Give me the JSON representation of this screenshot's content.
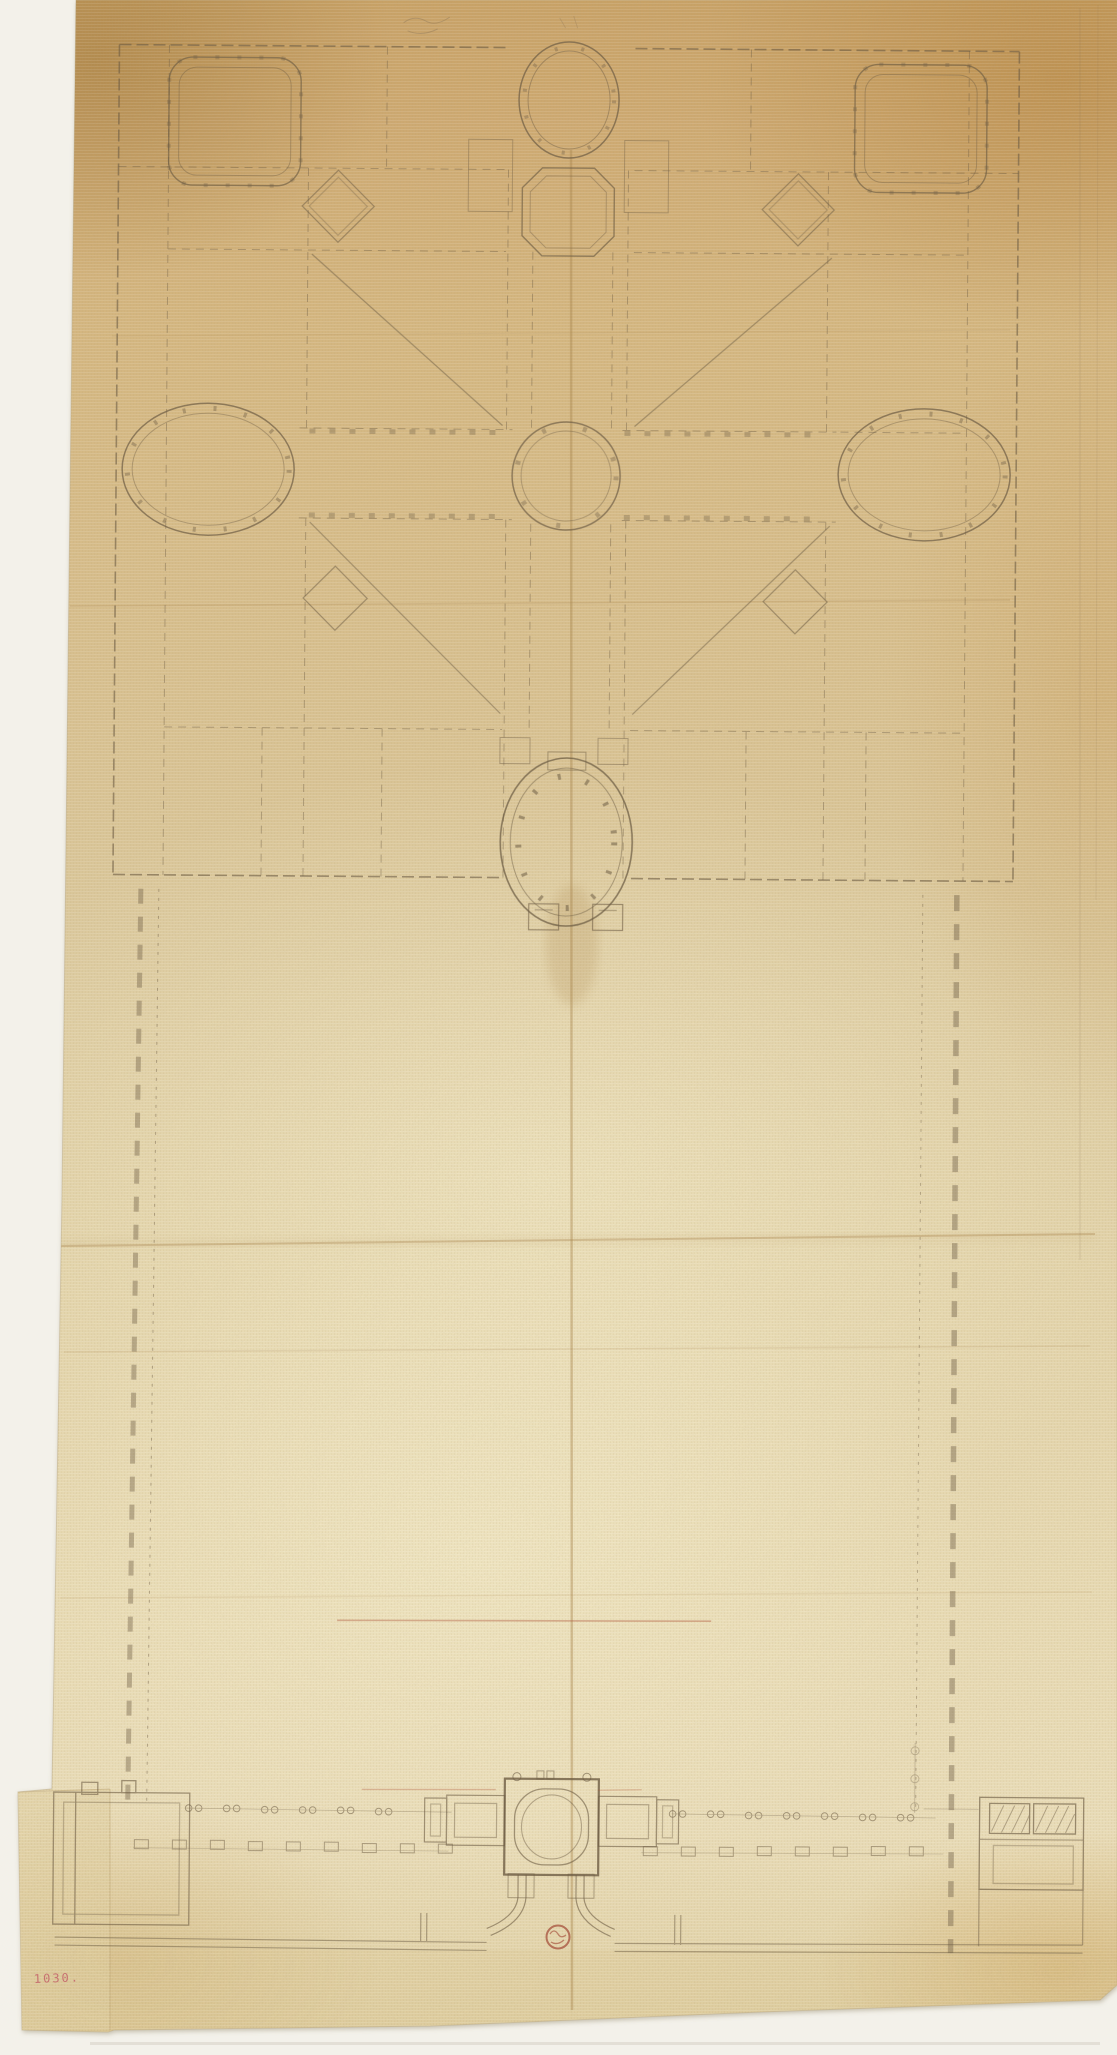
{
  "page": {
    "backdrop_color": "#f3f1ea"
  },
  "paper": {
    "tone_top_corner": "#a97c3f",
    "tone_upper": "#cda768",
    "tone_mid": "#dcc99b",
    "tone_light_center": "#f0e5c2",
    "fold_color": "#a8854e",
    "patch_note": "pasted patch at lower-left edge"
  },
  "drawing": {
    "ink_color": "#6e5d44",
    "red_chalk_color": "#b05a3e",
    "plan_parts": {
      "main_block": "square villa block with corner rooms, oval and octagonal vestibules, four great halls with diagonals, side oval rooms, central round hall",
      "rotunda": "circular colonnaded courtyard on garden front",
      "garden": "long walled garden court flanked by pier colonnades",
      "entrance_wing": "long gallery with central domed pavilion, side wings, semicircular exedra, corner blocks"
    },
    "gallery_column_pairs_left": 6,
    "gallery_column_pairs_right": 7
  },
  "inscriptions": {
    "inventory_number": "1030.",
    "inventory_color": "#c25b66"
  },
  "stamp": {
    "label": "collector-stamp",
    "color": "#a5503c"
  }
}
